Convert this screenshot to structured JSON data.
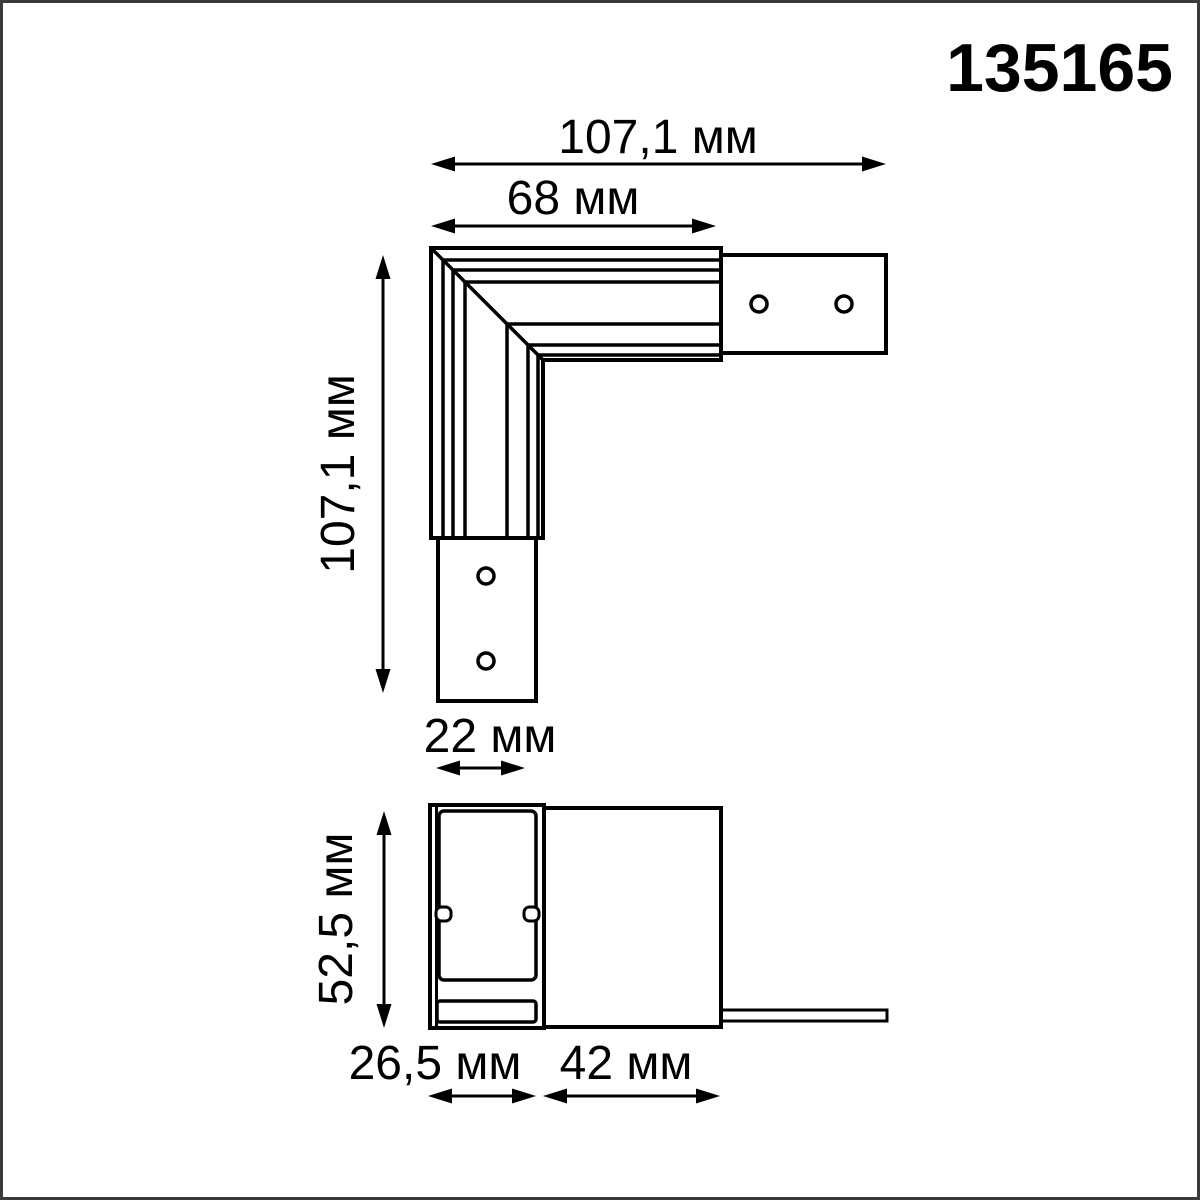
{
  "product_code": "135165",
  "drawing_title": "L-shaped track connector dimensional drawing",
  "colors": {
    "line": "#000000",
    "background": "#ffffff",
    "frame_border": "#3a3a3a"
  },
  "top_view": {
    "dim_total_width": "107,1 мм",
    "dim_track_length": "68 мм",
    "dim_total_height": "107,1 мм",
    "dim_tab_width": "22 мм"
  },
  "side_view": {
    "dim_height": "52,5 мм",
    "dim_track_section_width": "26,5 мм",
    "dim_body_width": "42 мм"
  }
}
